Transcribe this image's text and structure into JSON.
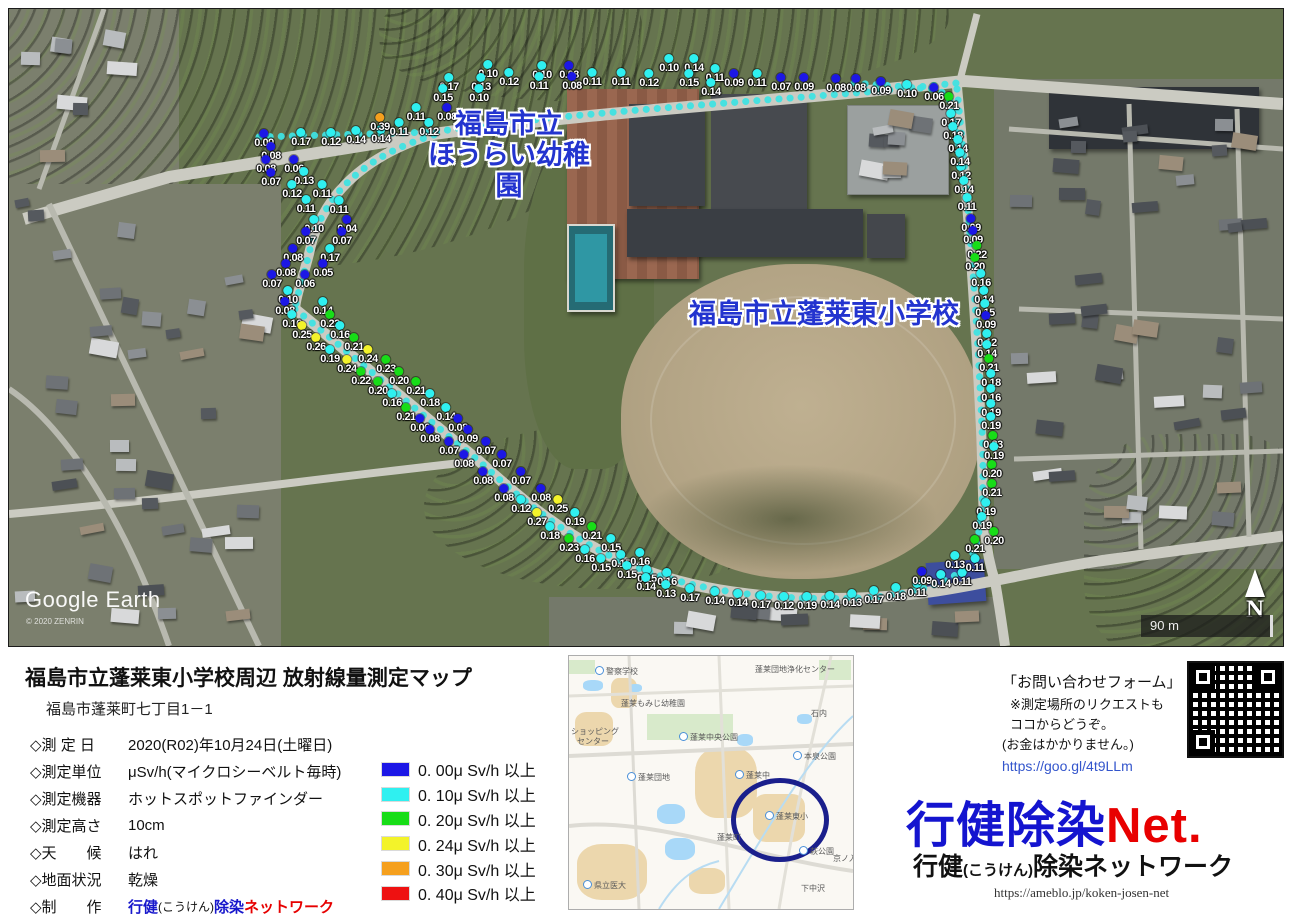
{
  "map": {
    "place_labels": {
      "kindergarten_line1": "福島市立",
      "kindergarten_line2": "ほうらい幼稚園",
      "school": "福島市立蓬莱東小学校"
    },
    "watermark": {
      "brand": "Google Earth",
      "copyright": "© 2020 ZENRIN"
    },
    "compass": "N",
    "scale": "90 m",
    "points": [
      [
        255,
        125,
        0.09
      ],
      [
        292,
        124,
        0.17
      ],
      [
        322,
        124,
        0.12
      ],
      [
        347,
        122,
        0.14
      ],
      [
        372,
        121,
        0.14
      ],
      [
        262,
        138,
        0.08
      ],
      [
        257,
        151,
        0.08
      ],
      [
        285,
        151,
        0.06
      ],
      [
        262,
        164,
        0.07
      ],
      [
        295,
        163,
        0.13
      ],
      [
        283,
        176,
        0.12
      ],
      [
        313,
        176,
        0.11
      ],
      [
        297,
        191,
        0.11
      ],
      [
        330,
        192,
        0.11
      ],
      [
        305,
        211,
        0.1
      ],
      [
        338,
        211,
        0.04
      ],
      [
        297,
        223,
        0.07
      ],
      [
        333,
        223,
        0.07
      ],
      [
        284,
        240,
        0.08
      ],
      [
        321,
        240,
        0.17
      ],
      [
        277,
        255,
        0.08
      ],
      [
        314,
        255,
        0.05
      ],
      [
        263,
        266,
        0.07
      ],
      [
        296,
        266,
        0.06
      ],
      [
        279,
        282,
        0.1
      ],
      [
        276,
        293,
        0.08
      ],
      [
        314,
        293,
        0.14
      ],
      [
        283,
        306,
        0.16
      ],
      [
        321,
        306,
        0.22
      ],
      [
        293,
        317,
        0.25
      ],
      [
        331,
        317,
        0.16
      ],
      [
        307,
        329,
        0.26
      ],
      [
        345,
        329,
        0.21
      ],
      [
        321,
        341,
        0.19
      ],
      [
        359,
        341,
        0.24
      ],
      [
        338,
        351,
        0.24
      ],
      [
        377,
        351,
        0.23
      ],
      [
        352,
        363,
        0.22
      ],
      [
        390,
        363,
        0.2
      ],
      [
        369,
        373,
        0.2
      ],
      [
        407,
        373,
        0.21
      ],
      [
        383,
        385,
        0.16
      ],
      [
        421,
        385,
        0.18
      ],
      [
        397,
        399,
        0.21
      ],
      [
        437,
        399,
        0.14
      ],
      [
        411,
        410,
        0.06
      ],
      [
        449,
        410,
        0.08
      ],
      [
        421,
        421,
        0.08
      ],
      [
        459,
        421,
        0.09
      ],
      [
        440,
        433,
        0.07
      ],
      [
        477,
        433,
        0.07
      ],
      [
        455,
        446,
        0.08
      ],
      [
        493,
        446,
        0.07
      ],
      [
        474,
        463,
        0.08
      ],
      [
        512,
        463,
        0.07
      ],
      [
        495,
        480,
        0.08
      ],
      [
        532,
        480,
        0.08
      ],
      [
        512,
        491,
        0.12
      ],
      [
        549,
        491,
        0.25
      ],
      [
        528,
        504,
        0.27
      ],
      [
        566,
        504,
        0.19
      ],
      [
        541,
        518,
        0.18
      ],
      [
        583,
        518,
        0.21
      ],
      [
        560,
        530,
        0.23
      ],
      [
        602,
        530,
        0.15
      ],
      [
        576,
        541,
        0.16
      ],
      [
        592,
        550,
        0.15
      ],
      [
        612,
        546,
        0.15
      ],
      [
        631,
        544,
        0.16
      ],
      [
        618,
        557,
        0.15
      ],
      [
        638,
        561,
        0.15
      ],
      [
        658,
        564,
        0.16
      ],
      [
        637,
        569,
        0.14
      ],
      [
        657,
        576,
        0.13
      ],
      [
        681,
        580,
        0.17
      ],
      [
        706,
        583,
        0.14
      ],
      [
        729,
        585,
        0.14
      ],
      [
        752,
        587,
        0.17
      ],
      [
        775,
        588,
        0.12
      ],
      [
        798,
        588,
        0.19
      ],
      [
        821,
        587,
        0.14
      ],
      [
        843,
        585,
        0.13
      ],
      [
        865,
        582,
        0.17
      ],
      [
        887,
        579,
        0.18
      ],
      [
        908,
        575,
        0.11
      ],
      [
        913,
        563,
        0.09
      ],
      [
        932,
        566,
        0.14
      ],
      [
        953,
        564,
        0.11
      ],
      [
        946,
        547,
        0.13
      ],
      [
        966,
        550,
        0.11
      ],
      [
        952,
        158,
        0.12
      ],
      [
        955,
        172,
        0.14
      ],
      [
        958,
        189,
        0.11
      ],
      [
        962,
        210,
        0.09
      ],
      [
        964,
        222,
        0.09
      ],
      [
        968,
        237,
        0.22
      ],
      [
        966,
        249,
        0.2
      ],
      [
        972,
        265,
        0.16
      ],
      [
        975,
        282,
        0.14
      ],
      [
        976,
        295,
        0.15
      ],
      [
        977,
        307,
        0.09
      ],
      [
        978,
        325,
        0.12
      ],
      [
        978,
        336,
        0.14
      ],
      [
        980,
        350,
        0.21
      ],
      [
        982,
        365,
        0.18
      ],
      [
        982,
        380,
        0.16
      ],
      [
        982,
        395,
        0.19
      ],
      [
        982,
        408,
        0.19
      ],
      [
        984,
        427,
        0.23
      ],
      [
        985,
        438,
        0.19
      ],
      [
        983,
        456,
        0.2
      ],
      [
        983,
        475,
        0.21
      ],
      [
        977,
        494,
        0.19
      ],
      [
        973,
        508,
        0.19
      ],
      [
        985,
        523,
        0.2
      ],
      [
        966,
        531,
        0.21
      ],
      [
        847,
        70,
        0.08
      ],
      [
        872,
        73,
        0.09
      ],
      [
        898,
        76,
        0.1
      ],
      [
        925,
        79,
        0.06
      ],
      [
        940,
        88,
        0.21
      ],
      [
        942,
        105,
        0.17
      ],
      [
        944,
        118,
        0.18
      ],
      [
        949,
        131,
        0.14
      ],
      [
        951,
        144,
        0.14
      ],
      [
        479,
        56,
        0.1
      ],
      [
        500,
        64,
        0.12
      ],
      [
        533,
        57,
        0.1
      ],
      [
        560,
        57,
        0.08
      ],
      [
        530,
        68,
        0.11
      ],
      [
        563,
        68,
        0.08
      ],
      [
        583,
        64,
        0.11
      ],
      [
        612,
        64,
        0.11
      ],
      [
        640,
        65,
        0.12
      ],
      [
        660,
        50,
        0.1
      ],
      [
        685,
        50,
        0.14
      ],
      [
        680,
        65,
        0.15
      ],
      [
        706,
        60,
        0.11
      ],
      [
        702,
        74,
        0.14
      ],
      [
        725,
        65,
        0.09
      ],
      [
        748,
        65,
        0.11
      ],
      [
        772,
        69,
        0.07
      ],
      [
        795,
        69,
        0.09
      ],
      [
        827,
        70,
        0.08
      ],
      [
        440,
        69,
        0.17
      ],
      [
        472,
        69,
        0.13
      ],
      [
        434,
        80,
        0.15
      ],
      [
        470,
        80,
        0.1
      ],
      [
        407,
        99,
        0.11
      ],
      [
        438,
        99,
        0.08
      ],
      [
        371,
        109,
        0.39
      ],
      [
        390,
        114,
        0.11
      ],
      [
        420,
        114,
        0.12
      ]
    ]
  },
  "legend": {
    "items": [
      {
        "threshold": 0.0,
        "color": "#1c17e6",
        "label": "0. 00μ Sv/h 以上"
      },
      {
        "threshold": 0.1,
        "color": "#2ff0f0",
        "label": "0. 10μ Sv/h 以上"
      },
      {
        "threshold": 0.2,
        "color": "#17dd17",
        "label": "0. 20μ Sv/h 以上"
      },
      {
        "threshold": 0.24,
        "color": "#f3f32a",
        "label": "0. 24μ Sv/h 以上"
      },
      {
        "threshold": 0.3,
        "color": "#f5a01e",
        "label": "0. 30μ Sv/h 以上"
      },
      {
        "threshold": 0.4,
        "color": "#ee1111",
        "label": "0. 40μ Sv/h 以上"
      }
    ]
  },
  "info": {
    "title": "福島市立蓬莱東小学校周辺  放射線量測定マップ",
    "address": "福島市蓬莱町七丁目1－1",
    "rows": [
      {
        "label": "◇測 定 日",
        "value": "2020(R02)年10月24日(土曜日)"
      },
      {
        "label": "◇測定単位",
        "value": "μSv/h(マイクロシーベルト毎時)"
      },
      {
        "label": "◇測定機器",
        "value": "ホットスポットファインダー"
      },
      {
        "label": "◇測定高さ",
        "value": "10cm"
      },
      {
        "label": "◇天　　候",
        "value": "はれ"
      },
      {
        "label": "◇地面状況",
        "value": "乾燥"
      }
    ],
    "maker_label": "◇制　　作",
    "maker": {
      "p1": "行健",
      "p2": "(こうけん)",
      "p3": "除染",
      "p4": "ネットワーク"
    }
  },
  "inset": {
    "circled_place": "蓬莱東小",
    "labels": [
      {
        "x": 26,
        "y": 10,
        "t": "警察学校",
        "ic": true
      },
      {
        "x": 186,
        "y": 8,
        "t": "蓬莱団地浄化センター"
      },
      {
        "x": 52,
        "y": 42,
        "t": "蓬莱もみじ幼稚園"
      },
      {
        "x": 2,
        "y": 70,
        "t": "ショッピング"
      },
      {
        "x": 8,
        "y": 80,
        "t": "センター"
      },
      {
        "x": 110,
        "y": 76,
        "t": "蓬莱中央公園",
        "ic": true
      },
      {
        "x": 242,
        "y": 52,
        "t": "石内"
      },
      {
        "x": 224,
        "y": 95,
        "t": "本泉公園",
        "ic": true
      },
      {
        "x": 58,
        "y": 116,
        "t": "蓬莱団地",
        "ic": true
      },
      {
        "x": 166,
        "y": 114,
        "t": "蓬莱中",
        "ic": true
      },
      {
        "x": 196,
        "y": 155,
        "t": "蓬莱東小",
        "ic": true
      },
      {
        "x": 148,
        "y": 176,
        "t": "蓬莱町"
      },
      {
        "x": 230,
        "y": 190,
        "t": "萩公園",
        "ic": true
      },
      {
        "x": 264,
        "y": 197,
        "t": "京ノ入"
      },
      {
        "x": 14,
        "y": 224,
        "t": "県立医大",
        "ic": true
      },
      {
        "x": 232,
        "y": 227,
        "t": "下中沢"
      }
    ]
  },
  "contact": {
    "line1": "「お問い合わせフォーム」",
    "line2": "※測定場所のリクエストも",
    "line3": "ココからどうぞ。",
    "line4": "(お金はかかりません。)",
    "link": "https://goo.gl/4t9LLm"
  },
  "branding": {
    "logo_blue": "行健除染",
    "logo_red": "Net.",
    "sub_p1": "行健",
    "sub_p2": "(こうけん)",
    "sub_p3": "除染ネットワーク",
    "url": "https://ameblo.jp/koken-josen-net"
  }
}
